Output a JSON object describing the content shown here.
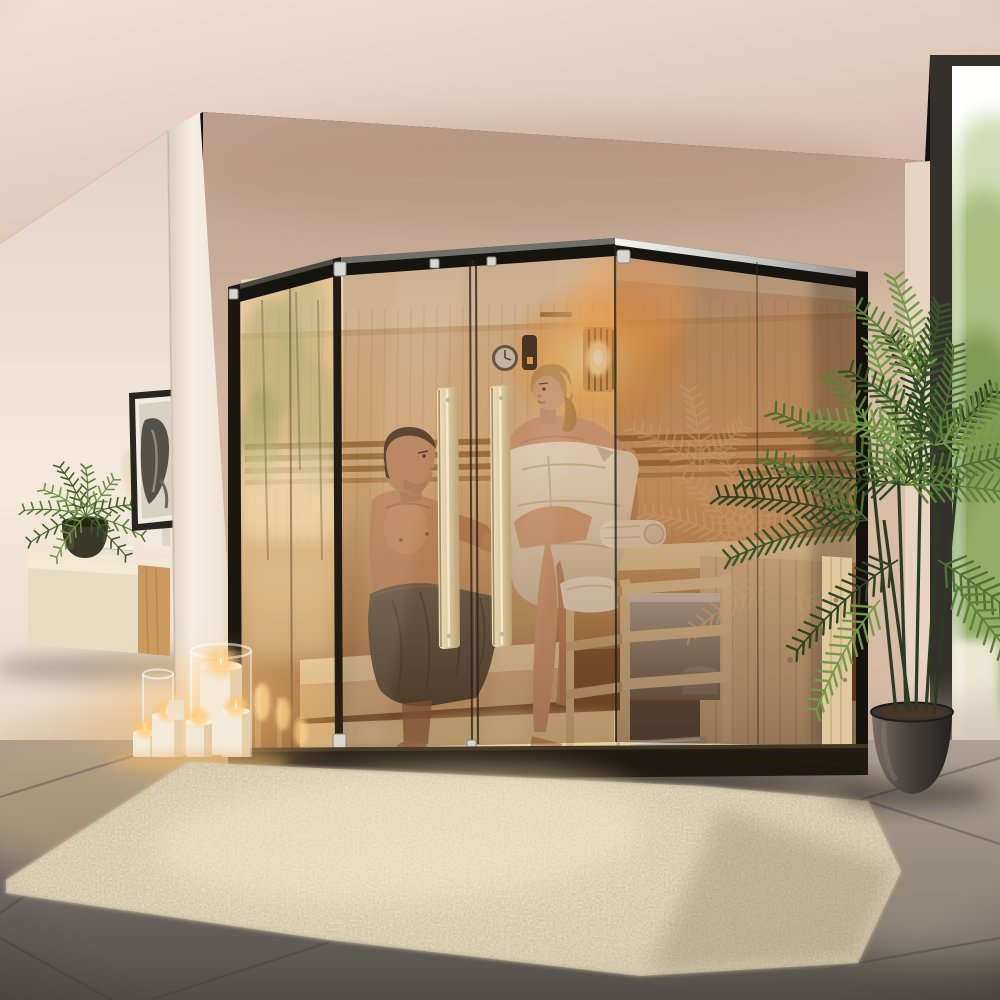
{
  "scene": {
    "title": "Photorealistic render of an indoor corner glass sauna: a couple in towels sits inside a pine sauna with a glowing wall lamp, wall clock and guarded heater; outside are lit pillar candles, a floating oak sideboard with fern and books, framed botanical art, a tall potted parlor palm beside a floor-to-ceiling window, gray tile floor and a cream shag rug.",
    "setting": "modern living room interior, warm evening light, no visible text",
    "objects": [
      {
        "id": "sauna",
        "label": "Corner glass sauna with black frame and steel top cap"
      },
      {
        "id": "sauna-doors",
        "label": "Double bronze-glass doors with long vertical wooden handles"
      },
      {
        "id": "man",
        "label": "Dark-haired man in a gray waist towel sitting on the lower bench"
      },
      {
        "id": "woman",
        "label": "Blonde woman wrapped in a white towel sitting on the upper bench"
      },
      {
        "id": "heater",
        "label": "Stainless sauna heater inside a wooden guard rail"
      },
      {
        "id": "wall-lamp",
        "label": "Glowing slatted wooden sauna wall lamp"
      },
      {
        "id": "clock",
        "label": "Round sauna wall clock beside a dark control panel"
      },
      {
        "id": "sideboard",
        "label": "Floating two-tone oak sideboard with books and vases"
      },
      {
        "id": "fern",
        "label": "Green fern in a dark pot on the sideboard"
      },
      {
        "id": "artwork",
        "label": "Framed dark botanical artwork on the left wall"
      },
      {
        "id": "candles",
        "label": "Cluster of lit cream pillar candles with glass hurricanes"
      },
      {
        "id": "rug",
        "label": "Cream shaggy area rug on gray tiles"
      },
      {
        "id": "palm",
        "label": "Tall potted parlor palm in a dark round planter"
      },
      {
        "id": "window",
        "label": "Floor-to-ceiling window with bright daylight and green foliage"
      },
      {
        "id": "floor",
        "label": "Large anthracite tile floor with diagonal grout lines"
      },
      {
        "id": "column",
        "label": "Cream structural column between sideboard and sauna"
      }
    ],
    "people": [
      {
        "id": "man",
        "hair": "short dark brown",
        "wearing": "gray towel",
        "pose": "seated, leaning back, arm resting toward the woman"
      },
      {
        "id": "woman",
        "hair": "blonde, tied back",
        "wearing": "white bath towel",
        "pose": "seated on upper bench, legs crossed"
      }
    ],
    "palette": {
      "ceiling_light": "#f0ddd0",
      "ceiling_shade": "#d2b6a5",
      "wall_left": "#f2e7da",
      "wall_back": "#c9ad99",
      "wall_back_deep": "#bda08d",
      "column": "#f4ece0",
      "window_frame": "#34312c",
      "window_glow": "#ffffff",
      "foliage_out": "#8fa862",
      "floor_mid": "#8d847c",
      "floor_dark": "#56514b",
      "floor_warm": "#c2a277",
      "rug_base": "#d9c8a6",
      "rug_light": "#f0e2be",
      "rug_shadow": "#a6957a",
      "sauna_frame": "#17140f",
      "metal": "#d9d9d5",
      "wood_interior": "#dcb98c",
      "wood_bench": "#f0dcae",
      "wood_slat": "#8f6234",
      "wood_plank": "#e2cba0",
      "wood_handle": "#ead8b2",
      "oak": "#c9985f",
      "lamp_glow": "#ffc068",
      "skin_man": "#bf8a66",
      "skin_woman": "#d6a687",
      "hair_man": "#38291f",
      "hair_woman": "#c59a5e",
      "towel_white": "#ece2cf",
      "towel_gray": "#56534a",
      "candle": "#f3ead8",
      "flame": "#ffd98a",
      "plant_dark": "#2f4423",
      "plant_mid": "#4e7031",
      "plant_light": "#729a47",
      "pot": "#3a3430",
      "art_dark": "#4e4943"
    }
  }
}
